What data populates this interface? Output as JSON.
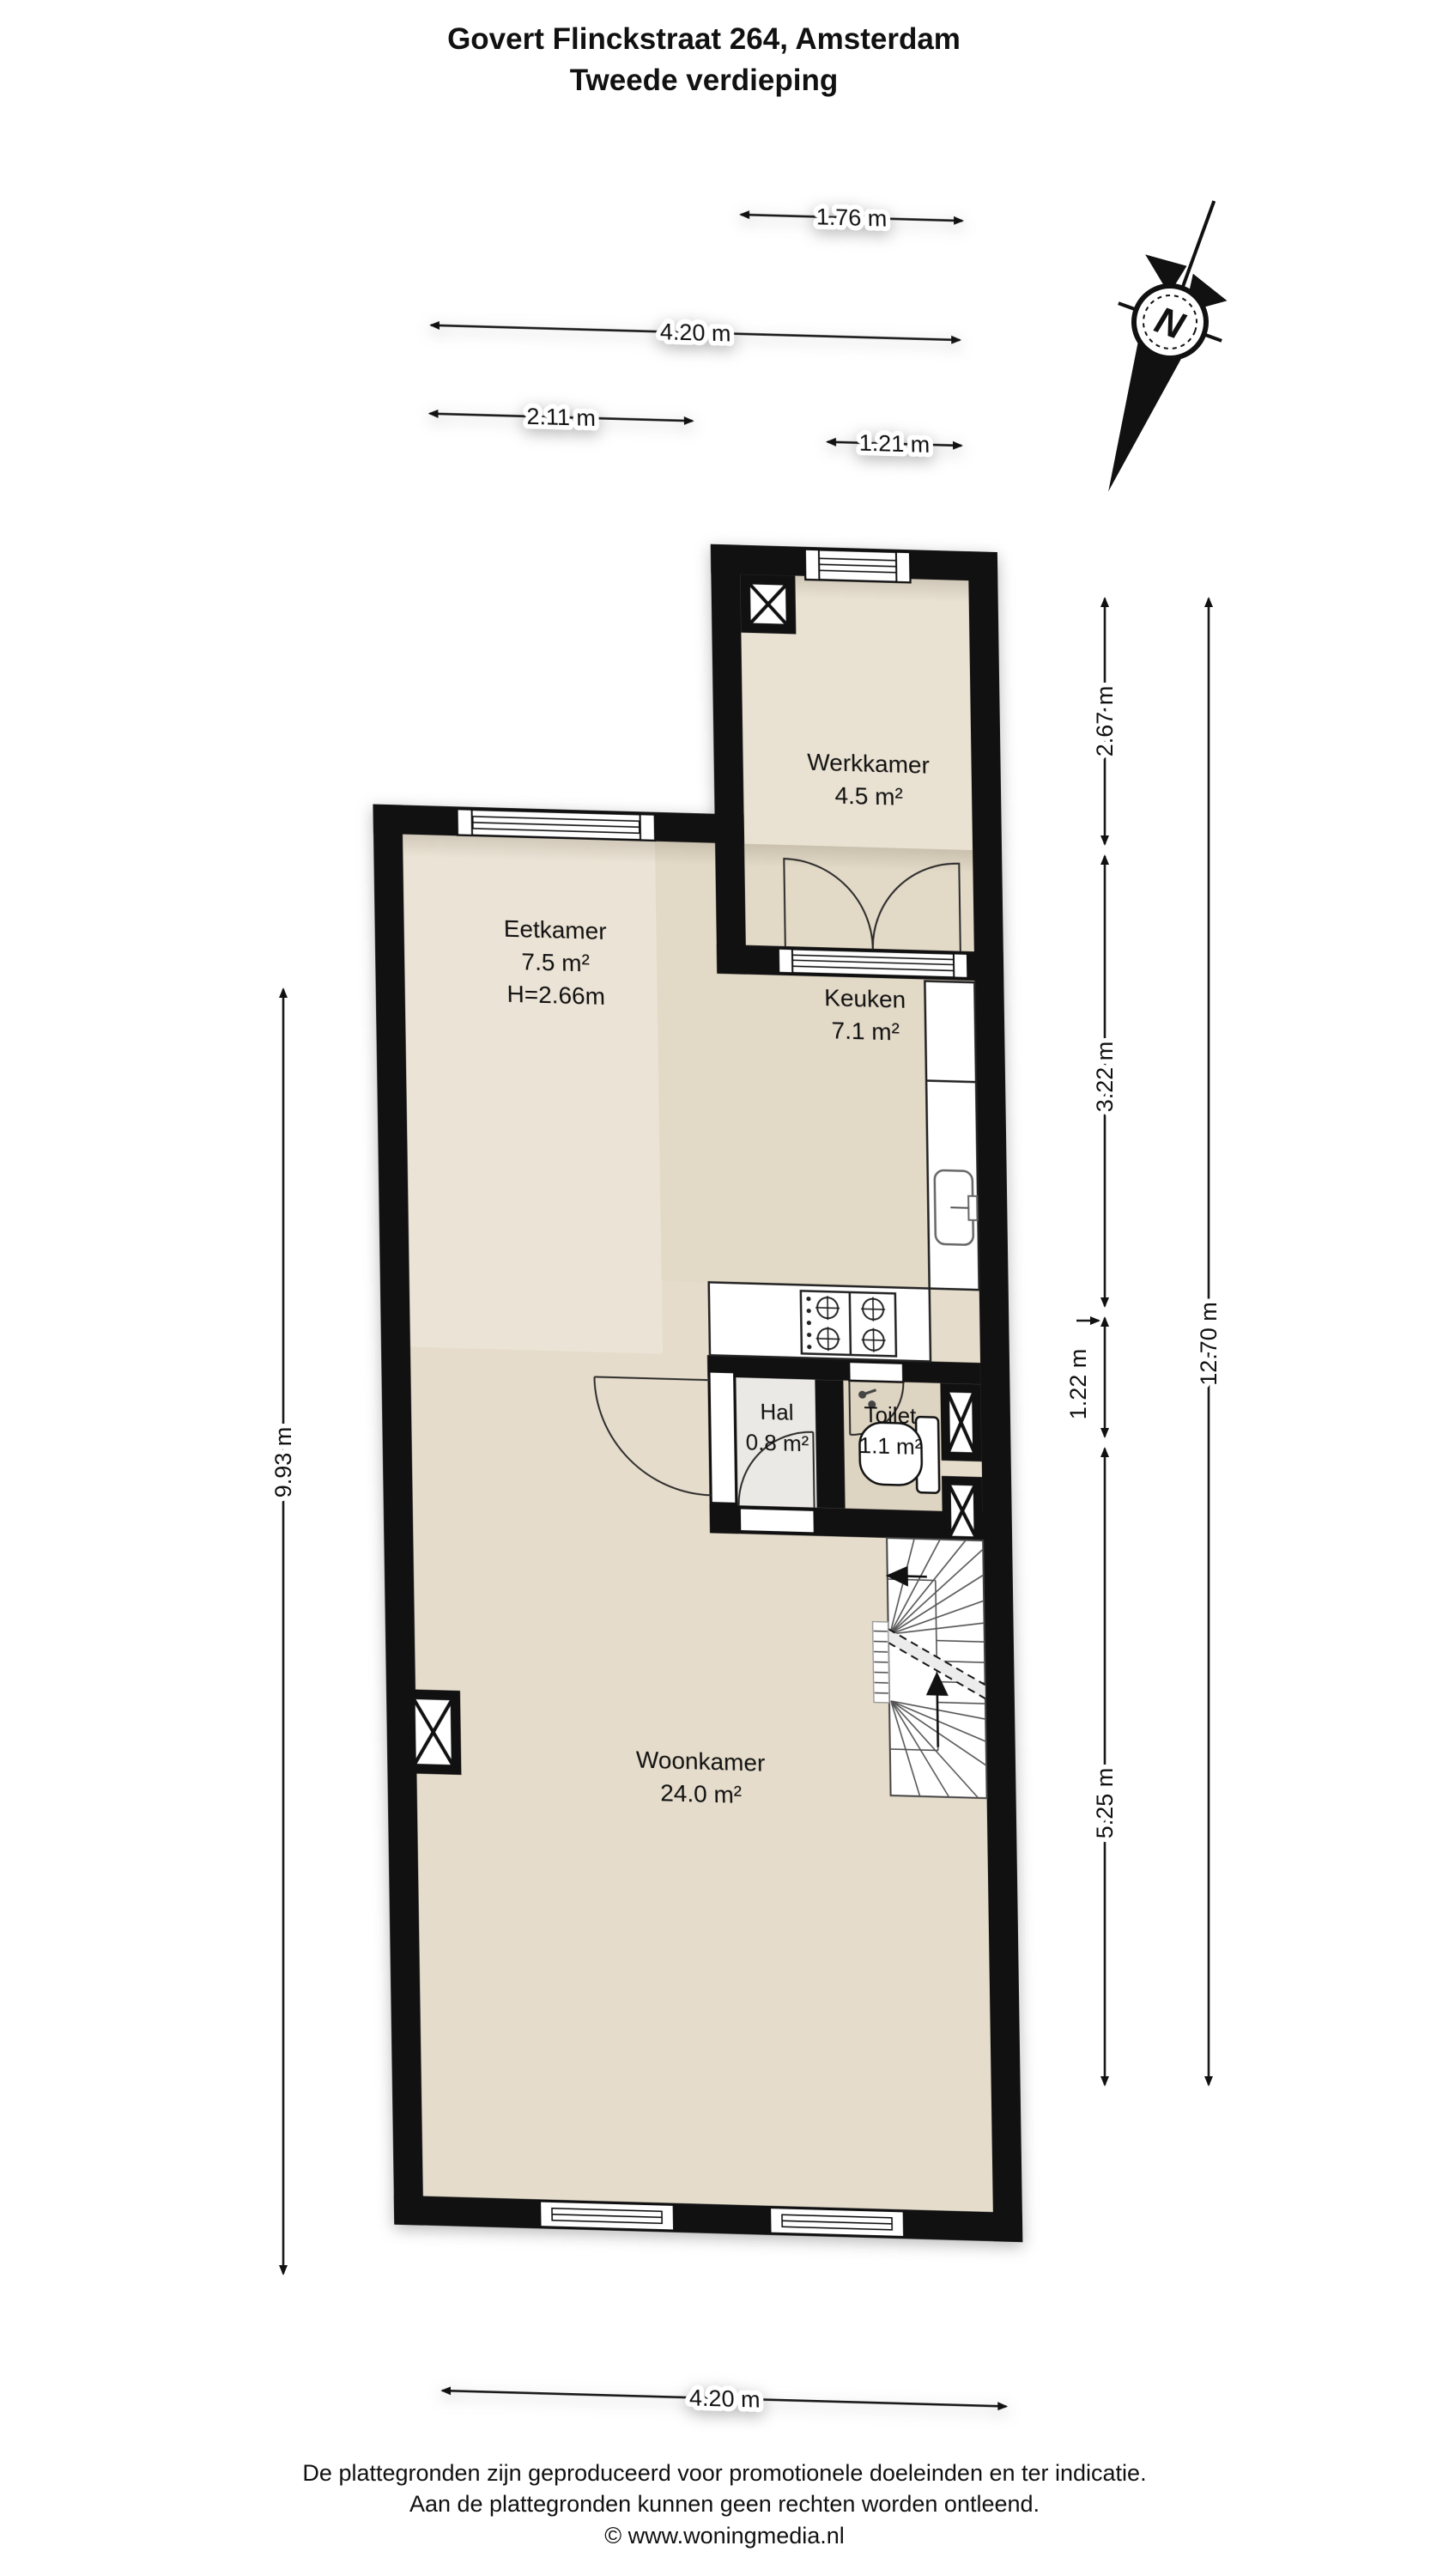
{
  "title": {
    "line1": "Govert Flinckstraat 264, Amsterdam",
    "line2": "Tweede verdieping"
  },
  "compass": {
    "label": "N"
  },
  "rooms": {
    "werkkamer": {
      "name": "Werkkamer",
      "area": "4.5 m²"
    },
    "eetkamer": {
      "name": "Eetkamer",
      "area": "7.5 m²",
      "height": "H=2.66m"
    },
    "keuken": {
      "name": "Keuken",
      "area": "7.1 m²"
    },
    "hal": {
      "name": "Hal",
      "area": "0.8 m²"
    },
    "toilet": {
      "name": "Toilet",
      "area": "1.1 m²"
    },
    "woonkamer": {
      "name": "Woonkamer",
      "area": "24.0 m²"
    }
  },
  "dimensions": {
    "top": [
      "1.76 m",
      "4.20 m",
      "2.11 m",
      "1.21 m"
    ],
    "right_inner": [
      "2.67 m",
      "3.22 m",
      "1.22 m",
      "5.25 m"
    ],
    "right_outer": "12.70 m",
    "left": "9.93 m",
    "bottom": "4.20 m"
  },
  "footer": {
    "line1": "De plattegronden zijn geproduceerd voor promotionele doeleinden en ter indicatie.",
    "line2": "Aan de plattegronden kunnen geen rechten worden ontleend.",
    "line3": "© www.woningmedia.nl"
  },
  "colors": {
    "wall": "#111111",
    "floor_main": "#e5dccb",
    "floor_eetkamer": "#ebe3d5",
    "floor_keuken": "#e2d9c7",
    "floor_werkkamer": "#e9e1d2",
    "floor_hal": "#eae9e5",
    "floor_toilet": "#ded4c2"
  }
}
